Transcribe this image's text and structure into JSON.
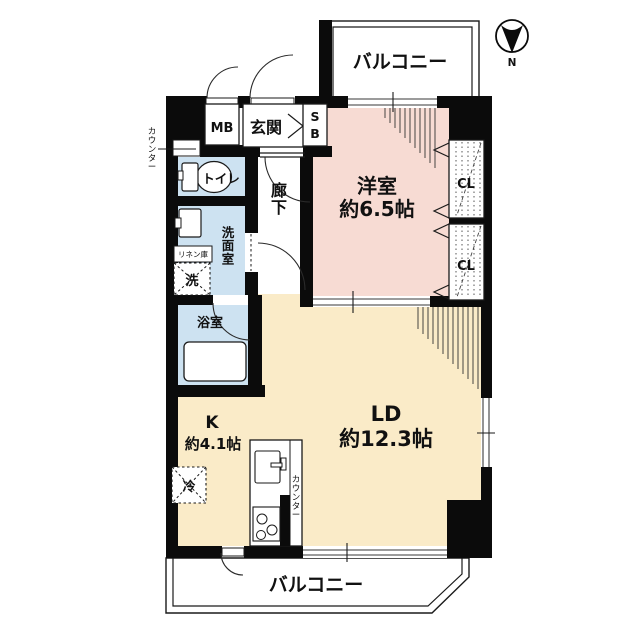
{
  "compass": {
    "north_label": "N"
  },
  "balconies": {
    "top": "バルコニー",
    "bottom": "バルコニー"
  },
  "rooms": {
    "western": {
      "name": "洋室",
      "size": "約6.5帖"
    },
    "living_dining": {
      "name": "LD",
      "size": "約12.3帖"
    },
    "kitchen": {
      "name": "K",
      "size": "約4.1帖"
    },
    "entrance": "玄関",
    "corridor": "廊下",
    "toilet": "トイレ",
    "washroom": "洗面室",
    "bathroom": "浴室"
  },
  "fixtures": {
    "meter_box": "MB",
    "shoe_box_line1": "S",
    "shoe_box_line2": "B",
    "closet_upper": "CL",
    "closet_lower": "CL",
    "linen_storage": "リネン庫",
    "washer": "洗",
    "fridge": "冷",
    "counter_toilet": "カウンター",
    "counter_kitchen": "カウンター"
  },
  "colors": {
    "western_room": "#f7dbd3",
    "ldk": "#faebc8",
    "wet_area": "#cde2f1",
    "wall": "#0b0b0b",
    "window": "#7a7a7a"
  }
}
